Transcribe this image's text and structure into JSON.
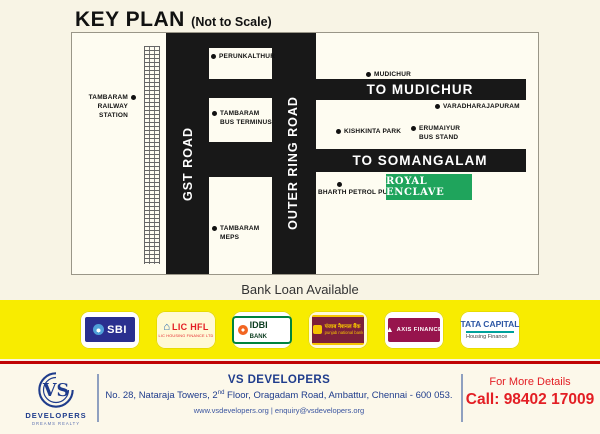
{
  "header": {
    "title": "KEY PLAN",
    "title_suffix": "(Not to Scale)"
  },
  "map": {
    "roads": {
      "gst": "GST ROAD",
      "outer_ring": "OUTER RING ROAD",
      "to_mudichur": "TO MUDICHUR",
      "to_somangalam": "TO SOMANGALAM"
    },
    "markers": {
      "railway_station": "TAMBARAM\nRAILWAY STATION",
      "perunkalthur": "PERUNKALTHUR",
      "bus_terminus": "TAMBARAM\nBUS TERMINUS",
      "meps": "TAMBARAM\nMEPS",
      "mudichur": "MUDICHUR",
      "varadharajapuram": "VARADHARAJAPURAM",
      "kishkinta_park": "KISHKINTA PARK",
      "erumaiyur_bus_stand": "ERUMAIYUR\nBUS STAND",
      "bharth_petrol": "BHARTH PETROL PUMB"
    },
    "site_label": "ROYAL ENCLAVE"
  },
  "loan_text": "Bank Loan Available",
  "banks": {
    "sbi": {
      "label": "SBI"
    },
    "lichfl": {
      "label": "LIC HFL",
      "sub": "LIC HOUSING FINANCE LTD",
      "house_icon": "⌂"
    },
    "idbi": {
      "label": "IDBI",
      "label2": "BANK"
    },
    "pnb": {
      "hindi": "पंजाब नैशनल बैंक",
      "eng": "punjab national bank"
    },
    "axis": {
      "label": "AXIS FINANCE",
      "triangle_icon": "▲"
    },
    "tata": {
      "label": "TATA CAPITAL",
      "sub": "Housing Finance"
    }
  },
  "footer": {
    "logo_monogram": "VS",
    "logo_name": "DEVELOPERS",
    "logo_tagline": "DREAMS REALTY",
    "company": "VS DEVELOPERS",
    "address_pre": "No. 28, Nataraja Towers, 2",
    "address_sup": "nd",
    "address_post": " Floor, Oragadam Road, Ambattur, Chennai - 600 053.",
    "web": "www.vsdevelopers.org | enquiry@vsdevelopers.org",
    "more_details": "For More Details",
    "call": "Call: 98402 17009"
  },
  "colors": {
    "page_bg": "#F8F4E5",
    "map_bg": "#FEFCF1",
    "road_black": "#181818",
    "site_green": "#1FA45C",
    "strip_yellow": "#F8EC00",
    "divider_red": "#C00404",
    "brand_navy": "#1F3C8C",
    "contact_red": "#E31E24"
  }
}
